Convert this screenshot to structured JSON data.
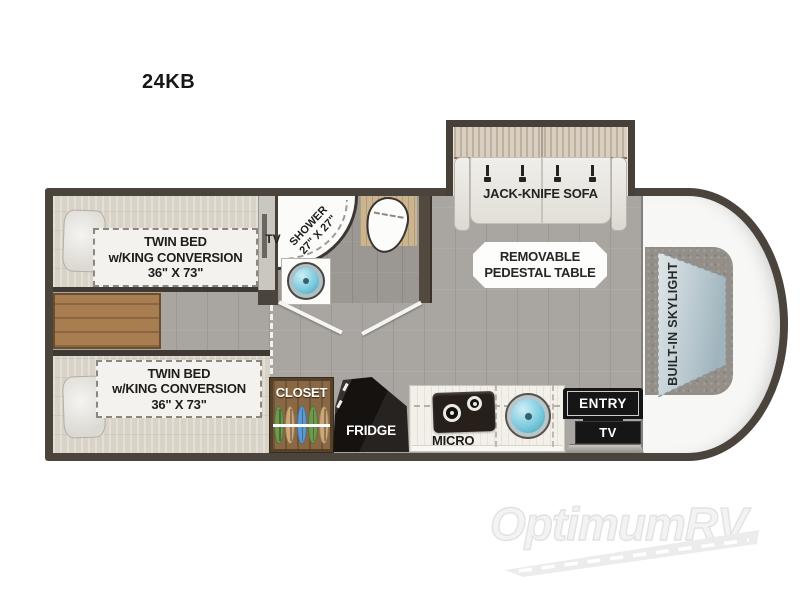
{
  "page": {
    "title": "24KB"
  },
  "plan": {
    "bedroom": {
      "beds": [
        {
          "line1": "TWIN BED",
          "line2": "w/KING CONVERSION",
          "line3": "36\" X 73\""
        },
        {
          "line1": "TWIN BED",
          "line2": "w/KING CONVERSION",
          "line3": "36\" X 73\""
        }
      ],
      "tv_label": "TV"
    },
    "bathroom": {
      "shower_line1": "SHOWER",
      "shower_line2": "27\" X 27\""
    },
    "living": {
      "sofa_label": "JACK-KNIFE SOFA",
      "table_line1": "REMOVABLE",
      "table_line2": "PEDESTAL TABLE",
      "skylight_label": "BUILT-IN SKYLIGHT"
    },
    "kitchen": {
      "closet_label": "CLOSET",
      "fridge_label": "FRIDGE",
      "micro_label": "MICRO",
      "entry_label": "ENTRY",
      "entry_tv_label": "TV"
    }
  },
  "watermark": {
    "brand": "OptimumRV"
  },
  "colors": {
    "wall": "#4a443c",
    "floor": "#a9a6a1",
    "bath_floor": "#9b9792",
    "wood": "#a87e50",
    "sink_blue": "#74c8dc",
    "skylight_blue": "#c0cfd5",
    "cab_white": "#f7f7f6"
  }
}
